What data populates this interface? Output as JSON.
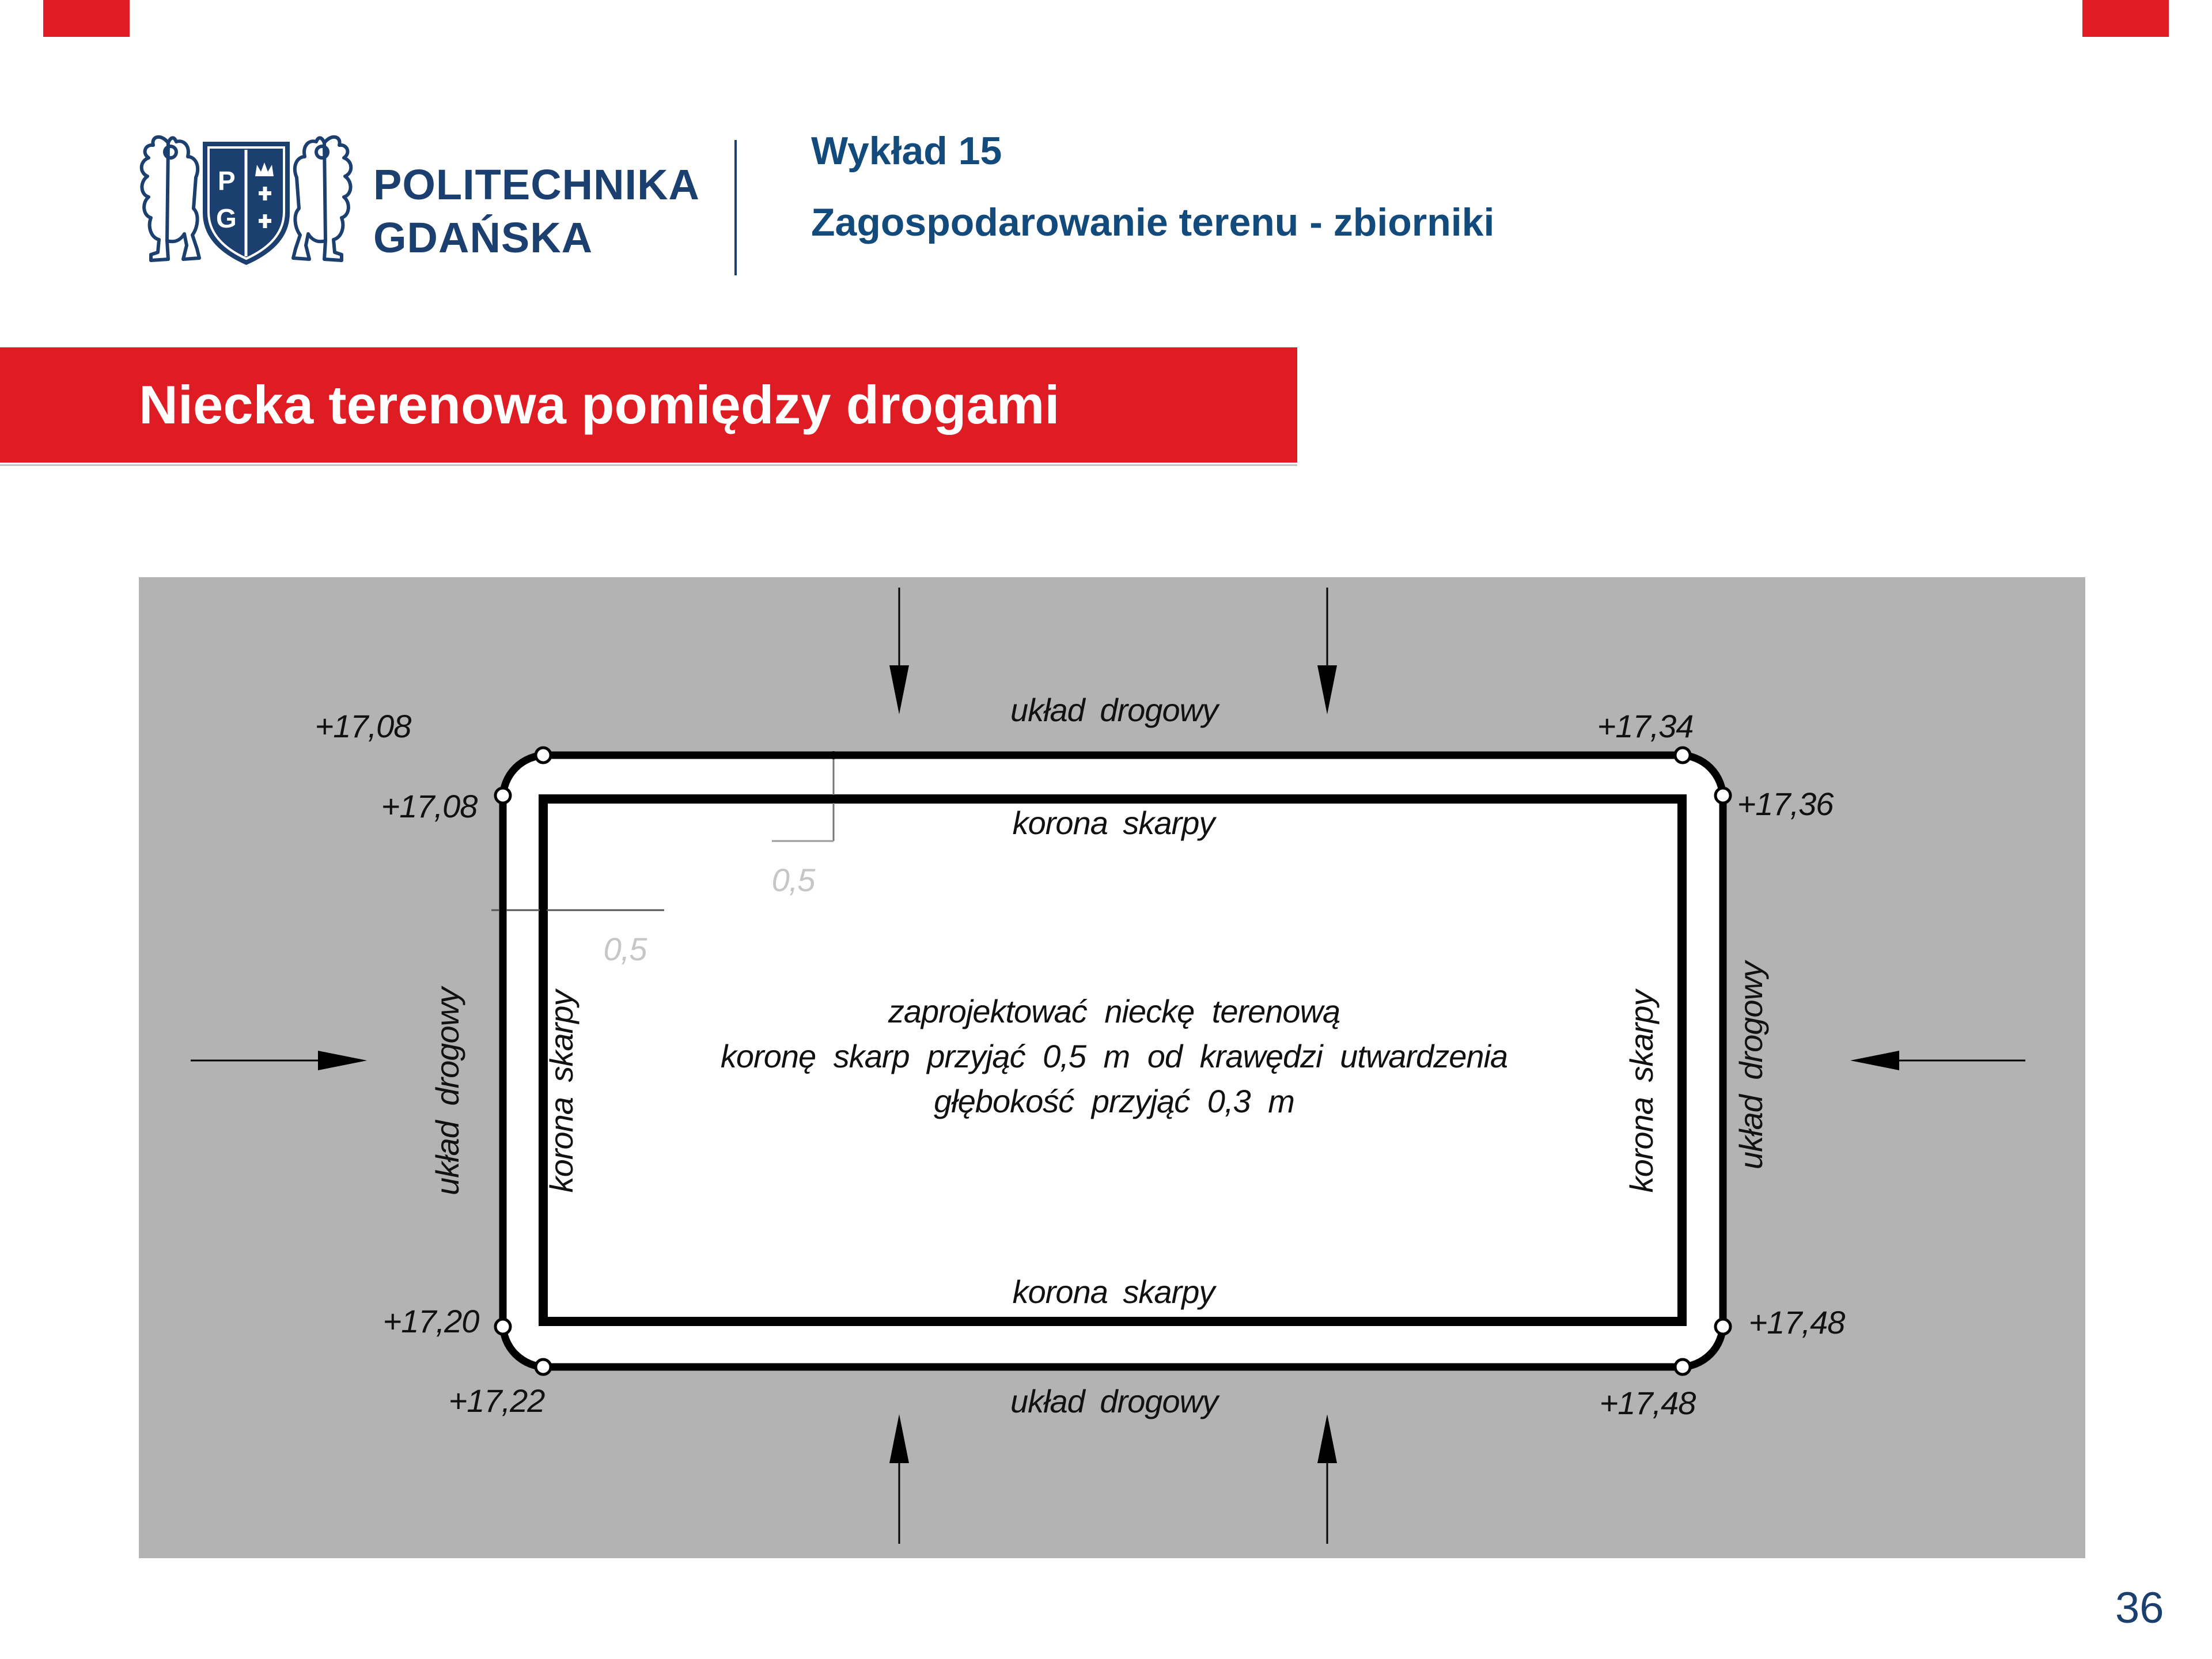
{
  "slide": {
    "page_number": "36"
  },
  "header": {
    "logo": {
      "name": "politechnika-gdanska-coat-of-arms",
      "shield_letter_top": "P",
      "shield_letter_bottom": "G"
    },
    "university_name_line1": "POLITECHNIKA",
    "university_name_line2": "GDAŃSKA",
    "lecture_label": "Wykład 15",
    "lecture_topic": "Zagospodarowanie terenu - zbiorniki"
  },
  "banner": {
    "title": "Niecka terenowa pomiędzy drogami"
  },
  "diagram": {
    "labels": {
      "road_top": "układ drogowy",
      "road_bottom": "układ drogowy",
      "road_left": "układ drogowy",
      "road_right": "układ drogowy",
      "crest_top": "korona skarpy",
      "crest_bottom": "korona skarpy",
      "crest_left": "korona skarpy",
      "crest_right": "korona skarpy"
    },
    "elevations": {
      "top_left_upper": "+17,08",
      "top_left_lower": "+17,08",
      "top_right_upper": "+17,34",
      "top_right_lower": "+17,36",
      "bottom_left_upper": "+17,20",
      "bottom_left_lower": "+17,22",
      "bottom_right_upper": "+17,48",
      "bottom_right_lower": "+17,48"
    },
    "dimensions": {
      "offset_top": "0,5",
      "offset_left": "0,5"
    },
    "note_line1": "zaprojektować nieckę terenową",
    "note_line2": "koronę skarp przyjąć 0,5 m od krawędzi utwardzenia",
    "note_line3": "głębokość przyjąć 0,3 m"
  },
  "colors": {
    "navy": "#1b3f6e",
    "red": "#df1c24",
    "diagram_bg": "#b3b3b3"
  }
}
